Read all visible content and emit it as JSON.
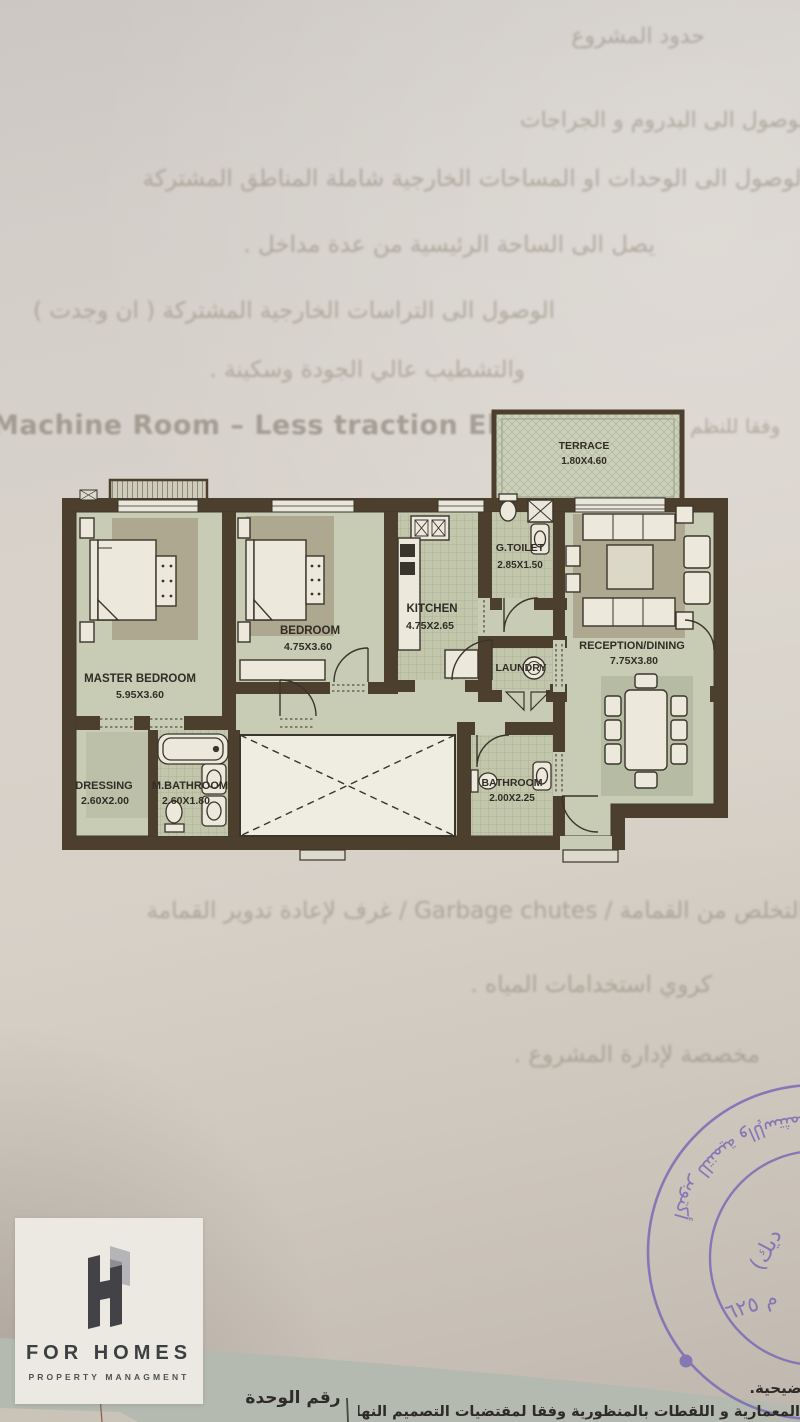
{
  "document_type": "apartment floor plan sheet",
  "colors": {
    "paper": "#d5cfc7",
    "wall": "#4d3f2d",
    "room_floor": "#c8ccb5",
    "tile_floor": "#c2c7ac",
    "rug": "#afa890",
    "furniture": "#ece8db",
    "label_text": "#312d26",
    "stamp_purple": "#7b6ab5",
    "band_green": "#b4bab0"
  },
  "floor_plan": {
    "rooms": [
      {
        "name": "TERRACE",
        "dims": "1.80X4.60"
      },
      {
        "name": "MASTER BEDROOM",
        "dims": "5.95X3.60"
      },
      {
        "name": "BEDROOM",
        "dims": "4.75X3.60"
      },
      {
        "name": "KITCHEN",
        "dims": "4.75X2.65"
      },
      {
        "name": "G.TOILET",
        "dims": "2.85X1.50"
      },
      {
        "name": "LAUNDRY",
        "dims": ""
      },
      {
        "name": "RECEPTION/DINING",
        "dims": "7.75X3.80"
      },
      {
        "name": "DRESSING",
        "dims": "2.60X2.00"
      },
      {
        "name": "M.BATHROOM",
        "dims": "2.60X1.80"
      },
      {
        "name": "BATHROOM",
        "dims": "2.00X2.25"
      }
    ]
  },
  "logo": {
    "title": "FOR HOMES",
    "subtitle": "PROPERTY MANAGMENT"
  },
  "stamp": {
    "ring_text": "أكتوبر للتنمية والإستثمار",
    "inner_line1": "(ديك",
    "inner_line2": "م ٦٢٥"
  },
  "bottom": {
    "unit_number_label": "رقم الوحدة",
    "note_right": "التوضيحية.",
    "note_bottom": "المعمارية و اللقطات بالمنظورية وفقا لمقتضيات التصميم النهائي و التنفيذ"
  },
  "bleed_text": {
    "l1": "حدود المشروع",
    "l2": "الوصول الى البدروم و الجراجات",
    "l3": "الوصول الى الوحدات او المساحات الخارجية شاملة المناطق المشتركة",
    "l4": "يصل الى الساحة الرئيسية من عدة مداخل .",
    "l5": "الوصول الى التراسات الخارجية المشتركة ( ان وجدت )",
    "l6": "والتشطيب عالي الجودة وسكينة .",
    "l7": "Machine Room – Less traction Elevator",
    "l7b": "وفقا للنظم",
    "l8": "التخلص من القمامة / Garbage chutes / غرف لإعادة تدوير القمامة",
    "l9": "كروي استخدامات المياه .",
    "l10": "مخصصة لإدارة المشروع ."
  }
}
